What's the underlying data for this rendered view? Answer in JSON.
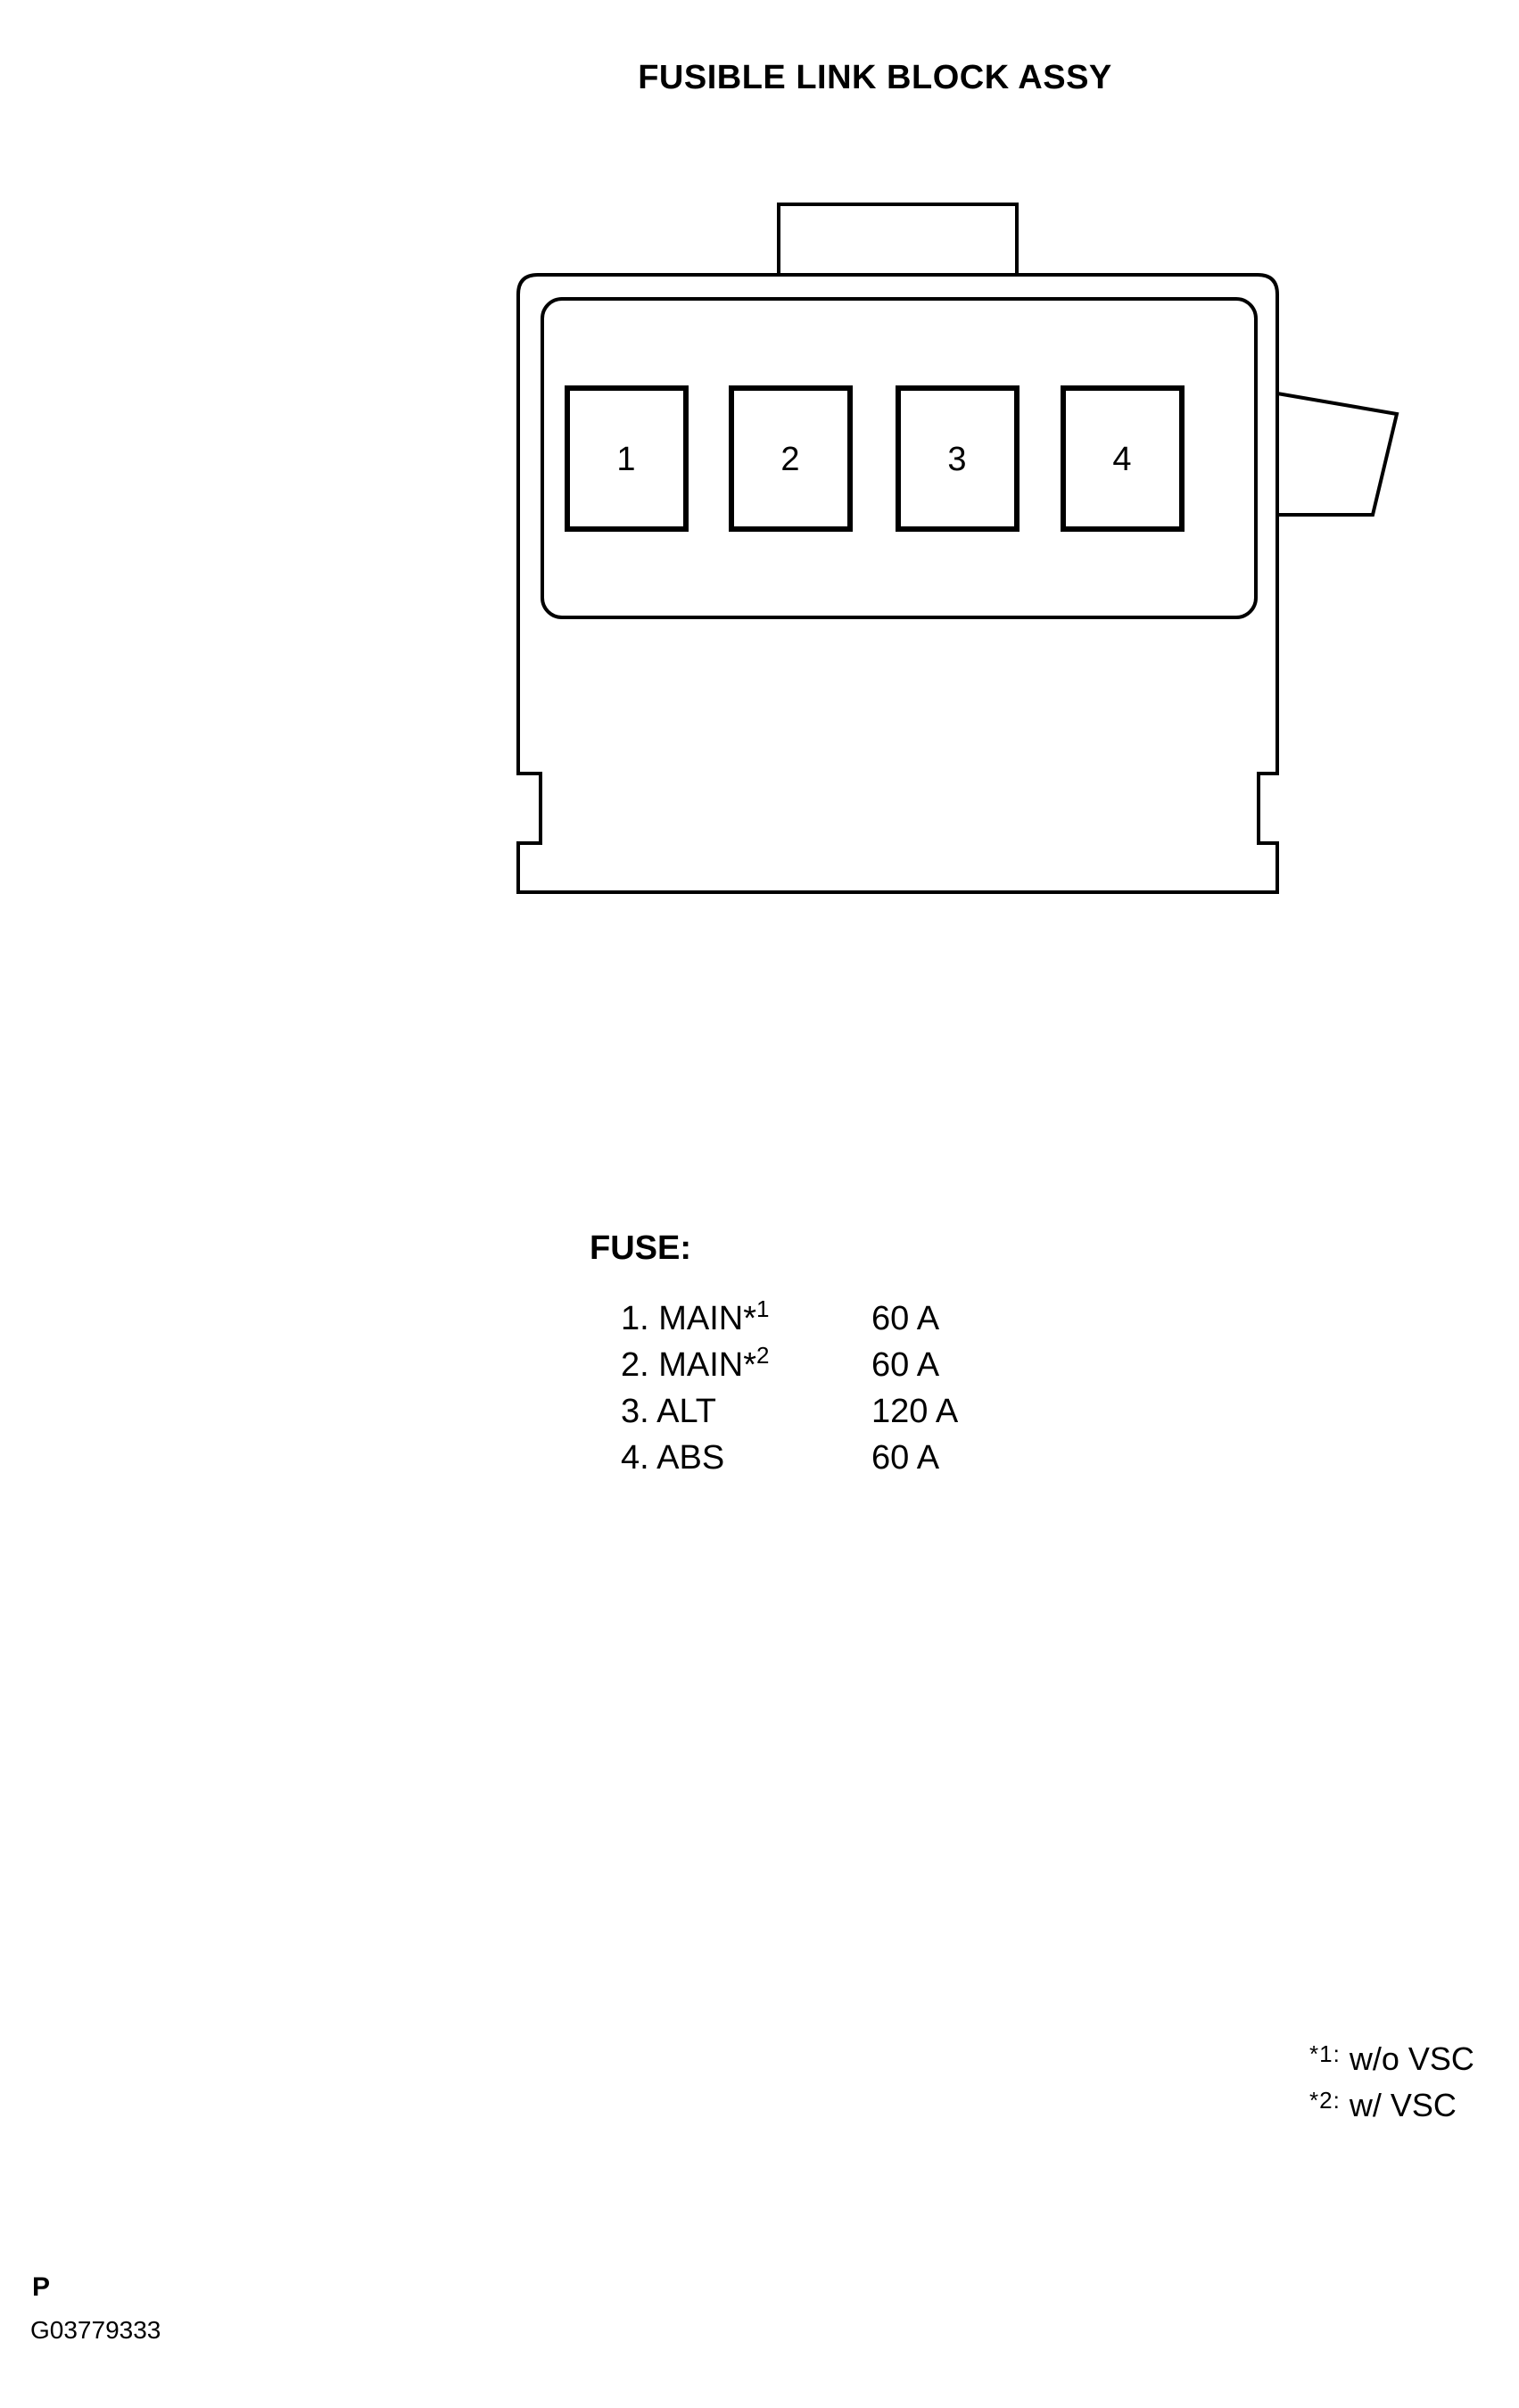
{
  "page": {
    "title": "FUSIBLE LINK BLOCK ASSY",
    "page_letter": "P",
    "figure_code": "G03779333"
  },
  "diagram": {
    "description": "front view of fusible link block connector with four fuse slots",
    "slots": [
      "1",
      "2",
      "3",
      "4"
    ]
  },
  "legend": {
    "heading": "FUSE:",
    "items": [
      {
        "label": "1. MAIN*",
        "sup": "1",
        "amps": "60 A"
      },
      {
        "label": "2. MAIN*",
        "sup": "2",
        "amps": "60 A"
      },
      {
        "label": "3. ALT",
        "sup": "",
        "amps": "120 A"
      },
      {
        "label": "4. ABS",
        "sup": "",
        "amps": "60 A"
      }
    ]
  },
  "footnotes": [
    {
      "mark": "*1:",
      "text": "w/o VSC"
    },
    {
      "mark": "*2:",
      "text": "w/ VSC"
    }
  ],
  "colors": {
    "line": "#000000",
    "background": "#ffffff"
  }
}
